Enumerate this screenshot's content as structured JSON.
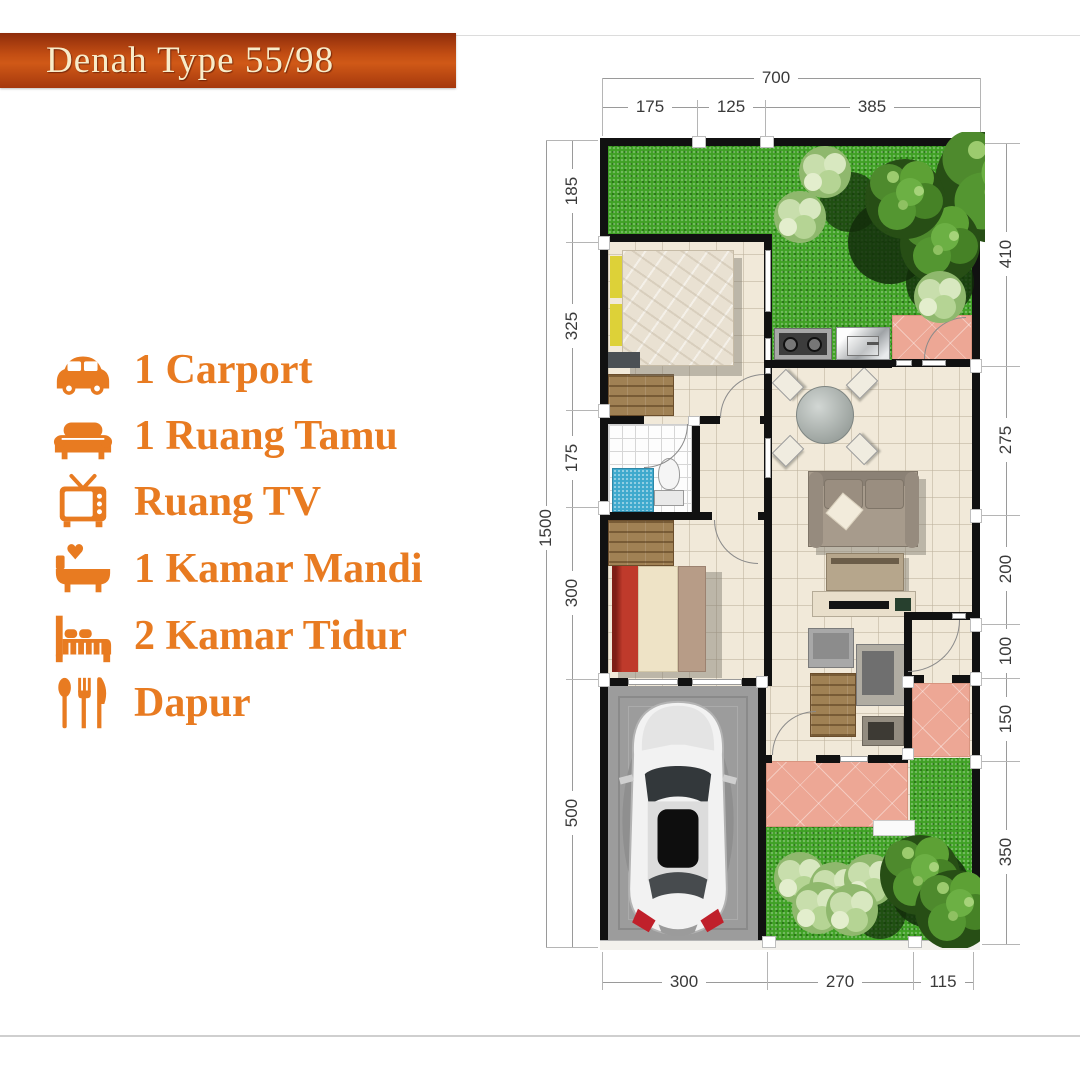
{
  "banner": {
    "title": "Denah Type 55/98",
    "bg": "#c24d13",
    "text_color": "#f8ecc9"
  },
  "legend": {
    "accent": "#e87b21",
    "items": [
      {
        "icon": "car-icon",
        "label": "1 Carport"
      },
      {
        "icon": "sofa-icon",
        "label": "1 Ruang Tamu"
      },
      {
        "icon": "tv-icon",
        "label": "Ruang TV"
      },
      {
        "icon": "bathtub-icon",
        "label": "1 Kamar Mandi"
      },
      {
        "icon": "bed-icon",
        "label": "2 Kamar Tidur"
      },
      {
        "icon": "cutlery-icon",
        "label": "Dapur"
      }
    ]
  },
  "plan": {
    "dimensions": {
      "top": {
        "total": "700",
        "segments": [
          "175",
          "125",
          "385"
        ]
      },
      "left": {
        "total": "1500",
        "segments": [
          "185",
          "325",
          "175",
          "300",
          "500"
        ]
      },
      "right": {
        "segments": [
          "410",
          "275",
          "200",
          "100",
          "150",
          "350"
        ]
      },
      "bottom": {
        "segments": [
          "300",
          "270",
          "115"
        ]
      }
    }
  },
  "colors": {
    "accent_orange": "#e87b21",
    "banner_bg": "#c24d13",
    "wall": "#111111",
    "grass": "#3fa124",
    "terrace": "#eda795",
    "carport": "#9c9c9c",
    "floor": "#f1e9d9",
    "bath_mat_blue": "#3ea9cd"
  }
}
